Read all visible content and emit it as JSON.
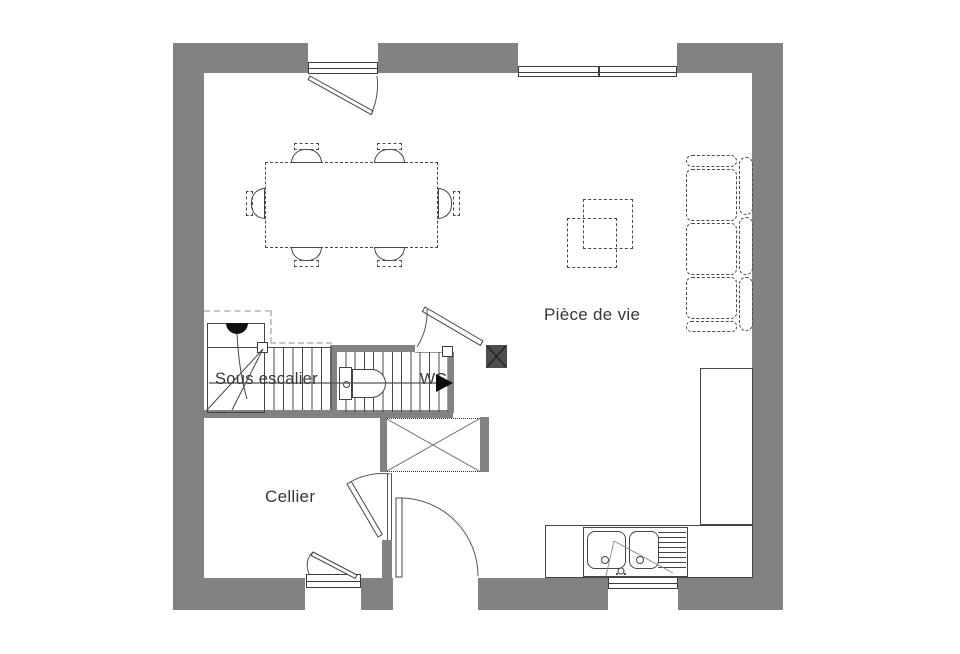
{
  "plan": {
    "type": "floor-plan",
    "labels": {
      "living": "Pièce de vie",
      "under_stairs": "Sous escalier",
      "cellar": "Cellier",
      "wc": "WC"
    },
    "colors": {
      "wall": "#828282",
      "line": "#444444",
      "dashed_light": "#c6c6c6",
      "post": "#4d4d4d",
      "background": "#ffffff",
      "text": "#383838"
    },
    "icons": {
      "walk_direction": "right-arrow-icon",
      "structural_post": "crossed-square-icon",
      "light_point": "lamp-half-disc-icon"
    }
  }
}
